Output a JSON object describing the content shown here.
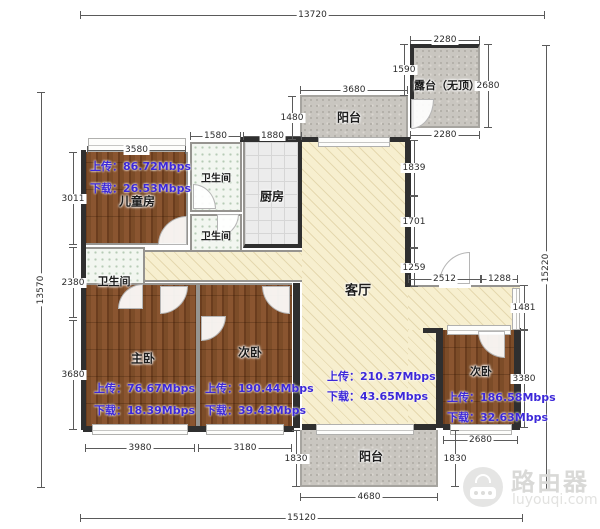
{
  "plan": {
    "rooms": {
      "children": {
        "name": "儿童房",
        "upload": "上传：86.72Mbps",
        "download": "下载：26.53Mbps"
      },
      "bath_top": {
        "name": "卫生间"
      },
      "bath_mid": {
        "name": "卫生间"
      },
      "bath_left": {
        "name": "卫生间"
      },
      "kitchen": {
        "name": "厨房"
      },
      "living": {
        "name": "客厅",
        "upload": "上传：210.37Mbps",
        "download": "下载：43.65Mbps"
      },
      "master": {
        "name": "主卧",
        "upload": "上传：76.67Mbps",
        "download": "下载：18.39Mbps"
      },
      "bed_mid": {
        "name": "次卧",
        "upload": "上传：190.44Mbps",
        "download": "下载：39.43Mbps"
      },
      "bed_right": {
        "name": "次卧",
        "upload": "上传：186.58Mbps",
        "download": "下载：32.63Mbps"
      },
      "balcony_top": {
        "name": "阳台"
      },
      "balcony_bottom": {
        "name": "阳台"
      },
      "terrace": {
        "name": "露台（无顶）"
      }
    },
    "dims": {
      "top_total": "13720",
      "bottom_total": "15120",
      "left_total": "13570",
      "right_total": "15220",
      "children_top": "3580",
      "bath_top_w": "1580",
      "kitchen_w": "1880",
      "balcony_top_w": "3680",
      "balcony_top_h": "1480",
      "terrace_top": "2280",
      "terrace_left": "1590",
      "terrace_right": "2680",
      "terrace_bottom": "2280",
      "children_left": "3011",
      "bath_left_h": "2380",
      "master_left": "3680",
      "master_bottom": "3980",
      "bed_mid_bottom": "3180",
      "balcony_bottom_left": "1830",
      "balcony_bottom_w": "4680",
      "balcony_bottom_right": "1830",
      "bed_right_bottom": "2680",
      "bed_right_side": "3380",
      "step_right": "1481",
      "step_w1": "2512",
      "step_w2": "1288",
      "living_right_1": "1839",
      "living_right_2": "1701",
      "living_right_3": "1259"
    },
    "colors": {
      "speed_text": "#3c28d9",
      "wood": "#7a4a28",
      "living_floor": "#f7efcf",
      "wall_dark": "#2f2f2f"
    }
  },
  "watermark": {
    "brand": "路由器",
    "site": "luyouqi.com"
  }
}
